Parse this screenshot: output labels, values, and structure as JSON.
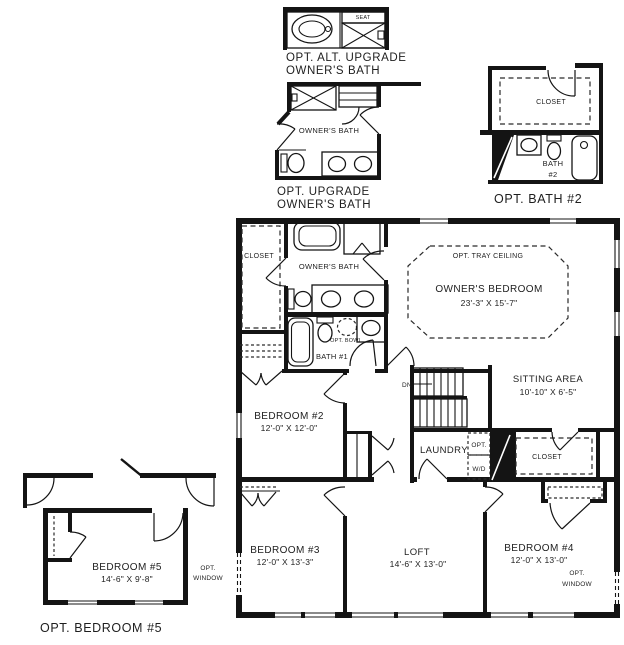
{
  "captions": {
    "alt_upgrade_line1": "OPT. ALT. UPGRADE",
    "alt_upgrade_line2": "OWNER'S BATH",
    "upgrade_line1": "OPT. UPGRADE",
    "upgrade_line2": "OWNER'S BATH",
    "opt_bath2": "OPT. BATH #2",
    "opt_bedroom5": "OPT. BEDROOM #5"
  },
  "rooms": {
    "owners_bedroom": {
      "name": "OWNER'S BEDROOM",
      "dims": "23'-3\" X 15'-7\"",
      "tray": "OPT. TRAY CEILING"
    },
    "sitting_area": {
      "name": "SITTING AREA",
      "dims": "10'-10\" X 6'-5\""
    },
    "bedroom2": {
      "name": "BEDROOM #2",
      "dims": "12'-0\" X 12'-0\""
    },
    "bedroom3": {
      "name": "BEDROOM #3",
      "dims": "12'-0\" X 13'-3\""
    },
    "bedroom4": {
      "name": "BEDROOM #4",
      "dims": "12'-0\" X 13'-0\""
    },
    "bedroom5": {
      "name": "BEDROOM #5",
      "dims": "14'-6\" X 9'-8\""
    },
    "loft": {
      "name": "LOFT",
      "dims": "14'-6\" X 13'-0\""
    },
    "laundry": {
      "name": "LAUNDRY"
    },
    "owners_bath_main": {
      "name": "OWNER'S BATH"
    },
    "owners_bath_upgrade": {
      "name": "OWNER'S BATH"
    },
    "bath1": {
      "name": "BATH #1"
    },
    "bath2": {
      "line1": "BATH",
      "line2": "#2"
    }
  },
  "labels": {
    "closet_owner": "CLOSET",
    "closet_hall": "CLOSET",
    "closet_bath2": "CLOSET",
    "seat": "SEAT",
    "dn": "DN",
    "opt_bowl": "OPT. BOWL",
    "opt_label": "OPT.",
    "wd_label": "W/D",
    "opt_window_line1": "OPT.",
    "opt_window_line2": "WINDOW"
  }
}
